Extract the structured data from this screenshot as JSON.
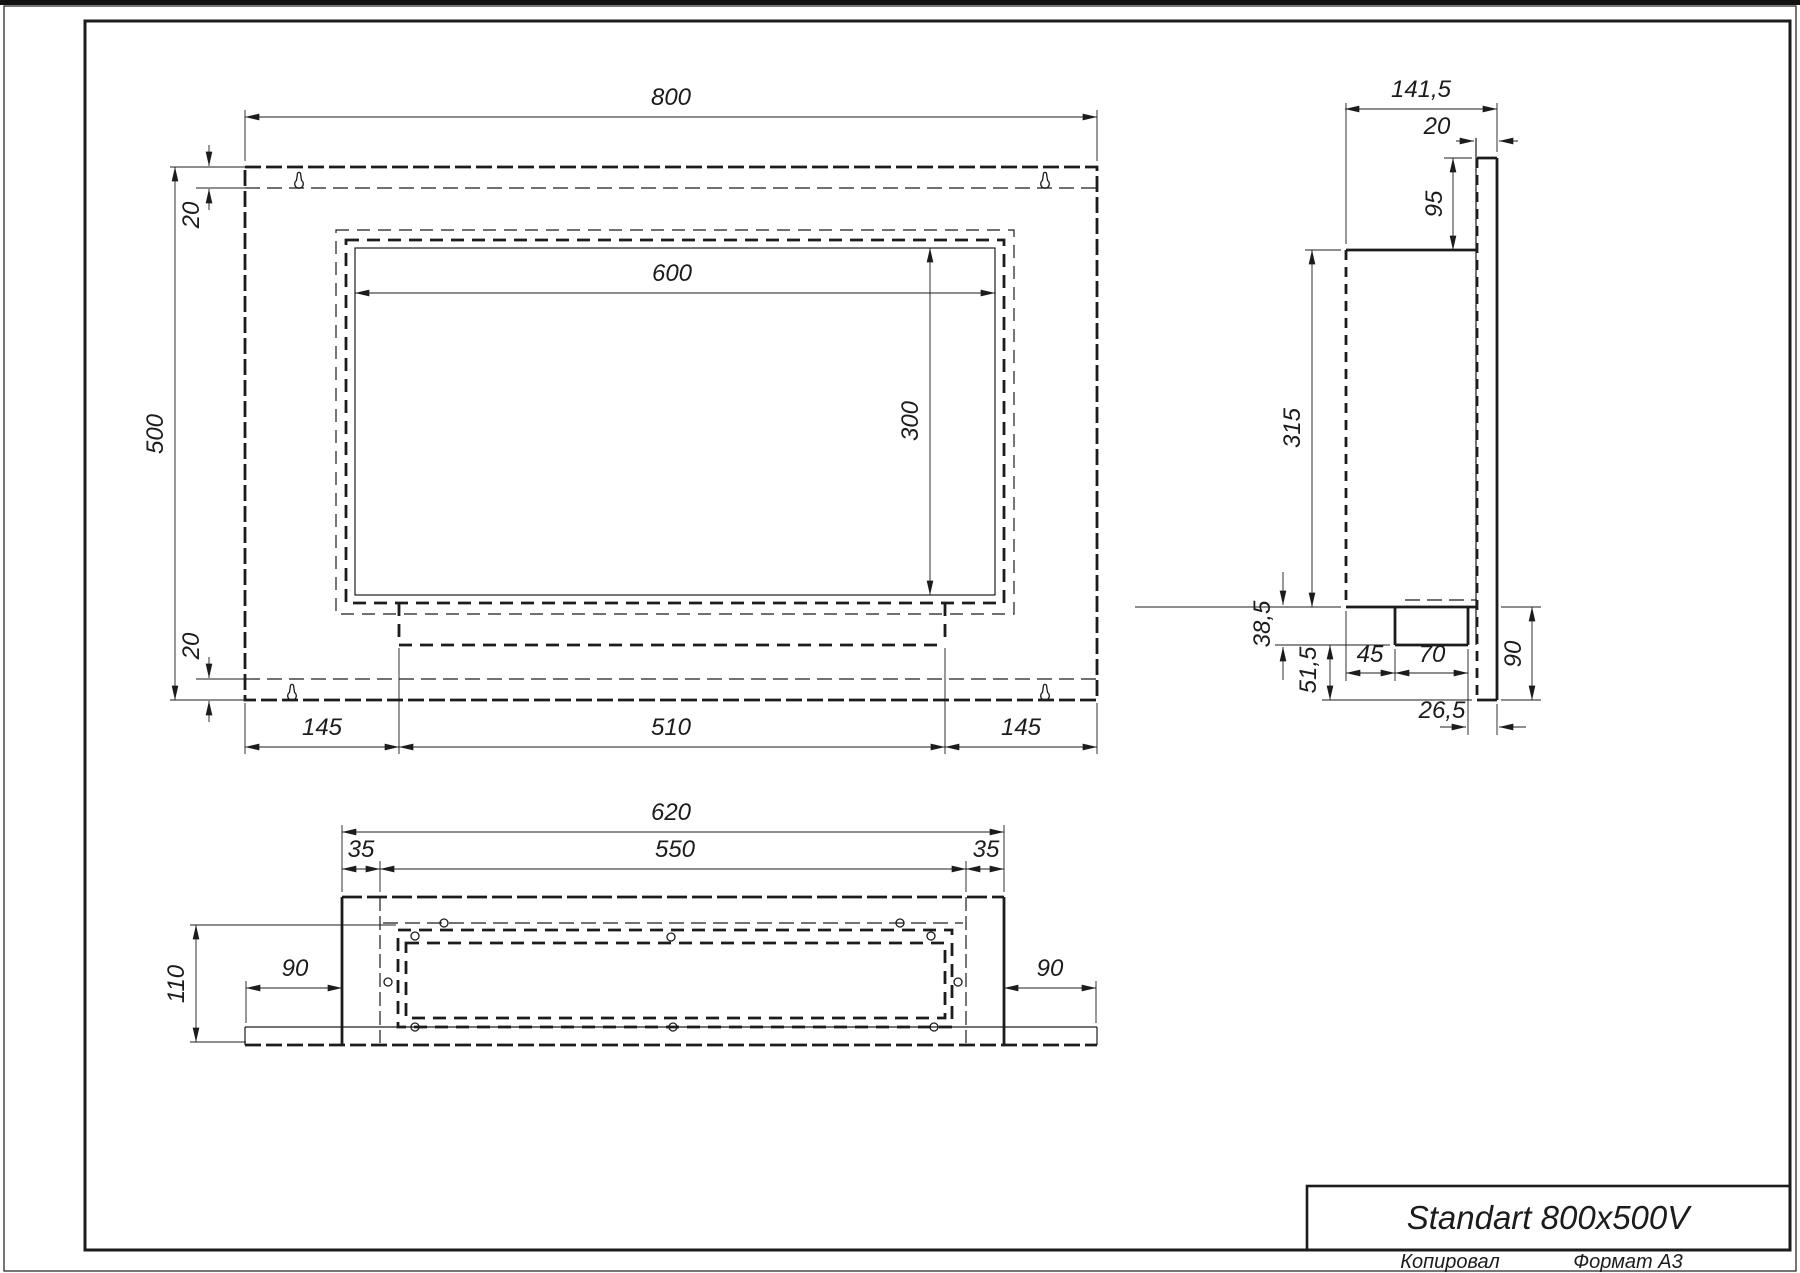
{
  "drawing": {
    "title_block": {
      "title": "Standart 800x500V",
      "copied_label": "Копировал",
      "format_label": "Формат A3"
    },
    "colors": {
      "ink": "#1c1c1c",
      "paper": "#ffffff"
    },
    "front_view": {
      "width": "800",
      "height": "500",
      "offset_top": "20",
      "offset_bottom": "20",
      "opening_width": "600",
      "opening_height": "300",
      "margin_left": "145",
      "tray_width": "510",
      "margin_right": "145"
    },
    "side_view": {
      "depth_total": "141,5",
      "panel_thickness": "20",
      "top_height": "95",
      "body_height": "315",
      "tray_depth": "38,5",
      "lower_depth": "51,5",
      "tray_offset": "45",
      "tray_width": "70",
      "panel_gap": "26,5",
      "panel_drop": "90"
    },
    "bottom_view": {
      "box_width": "620",
      "inner_width": "550",
      "fold_left": "35",
      "fold_right": "35",
      "depth": "110",
      "overhang_left": "90",
      "overhang_right": "90"
    }
  }
}
